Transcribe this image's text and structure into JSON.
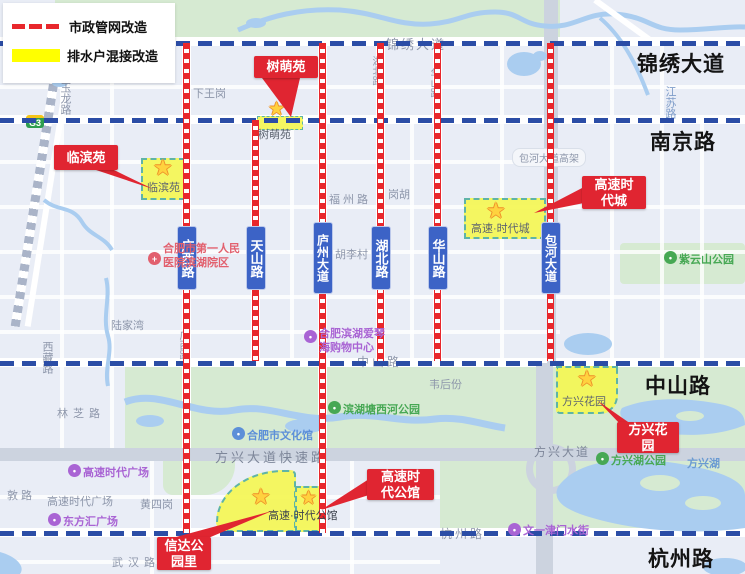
{
  "legend": {
    "pipe_label": "市政管网改造",
    "drain_label": "排水户混接改造",
    "pipe_color": "#e8272c",
    "drain_color": "#ffff00"
  },
  "avenues": {
    "jinxiu": "锦绣大道",
    "nanjing": "南京路",
    "zhongshan": "中山路",
    "hangzhou": "杭州路"
  },
  "road_badges": {
    "guangxi": "广西路",
    "tianshan": "天山路",
    "luzhou": "庐州大道",
    "hubei": "湖北路",
    "huashan": "华山路",
    "baohe": "包河大道"
  },
  "callouts": {
    "shumengyuan": {
      "line1": "树萌苑",
      "line2": ""
    },
    "linbinyuan": {
      "line1": "临滨苑",
      "line2": ""
    },
    "gaosu_shidaicheng": {
      "line1": "高速时",
      "line2": "代城"
    },
    "fangxing_huayuan": {
      "line1": "方兴花",
      "line2": "园"
    },
    "gaosu_gongguan": {
      "line1": "高速时",
      "line2": "代公馆"
    },
    "xinda_gongyuanli": {
      "line1": "信达公",
      "line2": "园里"
    }
  },
  "zones": {
    "shumengyuan": "树萌苑",
    "linbinyuan": "临滨苑",
    "gaosu_shidaicheng": "高速·时代城",
    "fangxing_huayuan": "方兴花园",
    "gaosu_gongguan": "高速·时代公馆"
  },
  "map_labels": {
    "yulonglu": "玉龙路",
    "xiawanggang": "下王岗",
    "jinxiu_map": "锦绣大道",
    "jiangsulu": "江苏路",
    "baohe_gaojia": "包河大道高架",
    "fuzhoulu": "福州路",
    "ganghu": "岗胡",
    "hulicun": "胡李村",
    "hubei_map": "湖北路",
    "huashan_map": "华山路",
    "guangxi_map": "广西路",
    "lujiawan": "陆家湾",
    "xizanglu": "西藏路",
    "linzhilu": "林芝路",
    "zhongshan_map": "中山路",
    "weihoufen": "韦后份",
    "fangxing_express": "方兴大道快速路",
    "fangxing_ave": "方兴大道",
    "hangzhou_map": "杭州路",
    "gaosu_plaza_map": "高速时代广场",
    "huangsigang": "黄四岗",
    "wuhanlu": "武汉路",
    "dunlu": "敦 路",
    "fangxinghu": "方兴湖",
    "g3": "G3"
  },
  "pois": {
    "hospital_line1": "合肥市第一人民",
    "hospital_line2": "医院滨湖院区",
    "aiqinhai_line1": "合肥滨湖爱琴",
    "aiqinhai_line2": "海购物中心",
    "ziyunshan": "紫云山公园",
    "tangxihe": "滨湖塘西河公园",
    "wenhuaguan": "合肥市文化馆",
    "gaosu_plaza": "高速时代广场",
    "dongfanghui": "东方汇广场",
    "wenyi_shuijie": "文一津门水街",
    "fangxinghu_park": "方兴湖公园"
  },
  "icons": {
    "star": "★",
    "cross": "+",
    "dot": "•"
  },
  "colors": {
    "municipal_line": "#e8272c",
    "avenue_dash": "#2b4da6",
    "zone_fill": "#f4f654",
    "badge_blue": "#3c63c6",
    "callout_red": "#e02531"
  }
}
